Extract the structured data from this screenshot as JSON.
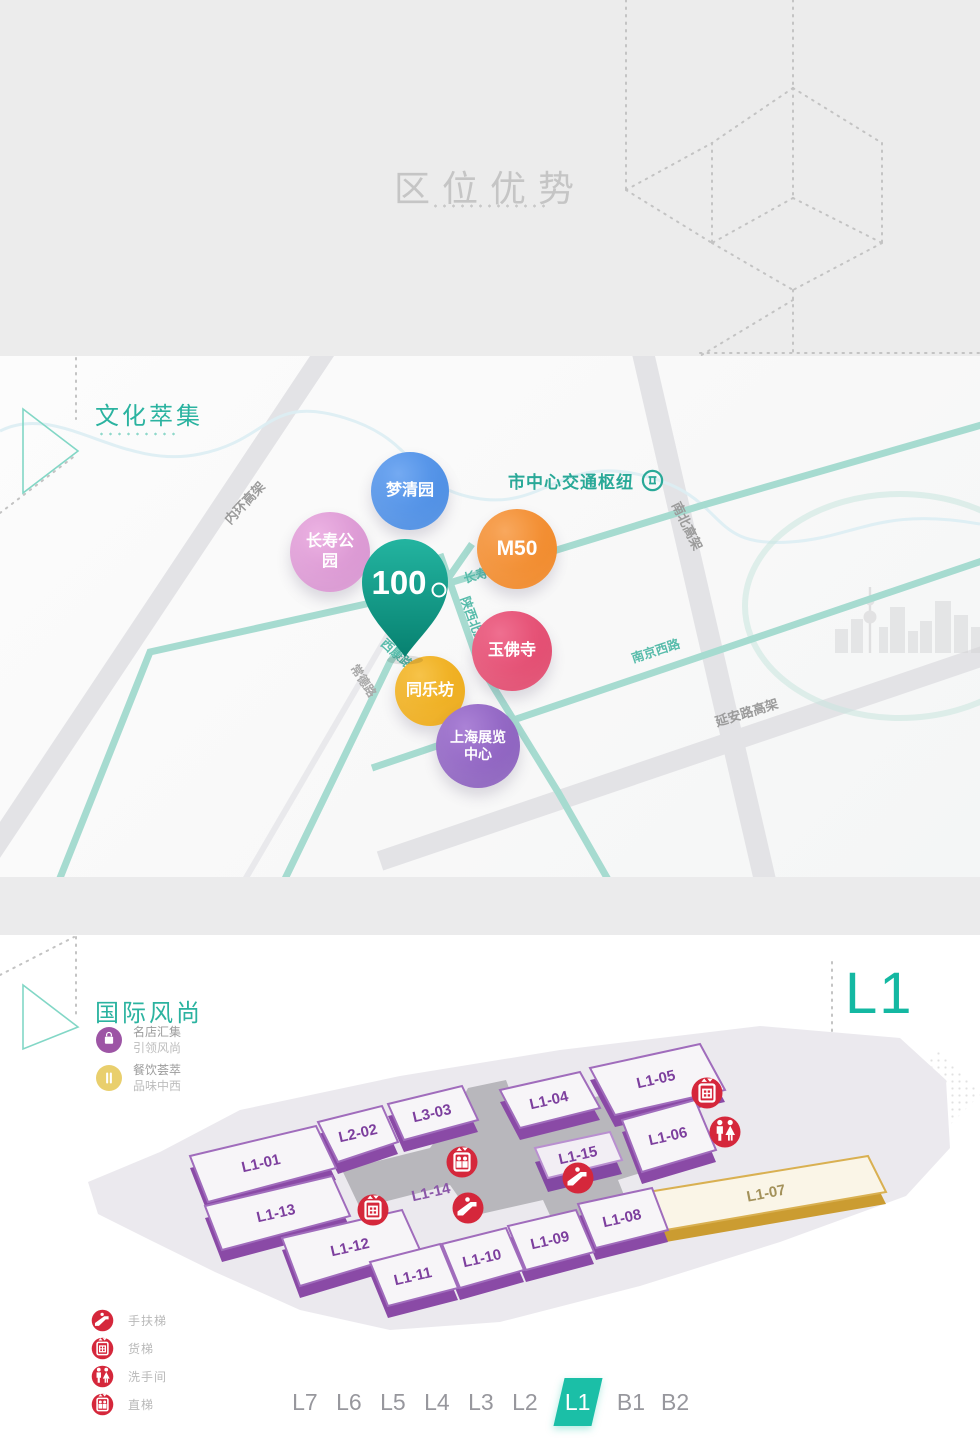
{
  "colors": {
    "accent_teal": "#14b8a2",
    "section_title_teal": "#2bb3a0",
    "header_title_gray": "#c5c5c5",
    "unit_purple": "#7d3f9e",
    "unit_gold": "#cfa43b",
    "facility_red": "#d5273b",
    "highway_gray": "#e3e3e6",
    "teal_road": "#a6dbd0"
  },
  "header": {
    "title": "区位优势"
  },
  "map_section": {
    "title": "文化萃集",
    "hub_label": "市中心交通枢纽",
    "pin_label": "100",
    "pois": [
      {
        "label": "梦清园",
        "color": "#4f94e8"
      },
      {
        "label": "长寿公园",
        "color": "#d790cf"
      },
      {
        "label": "M50",
        "color": "#f0821d"
      },
      {
        "label": "玉佛寺",
        "color": "#e04167"
      },
      {
        "label": "同乐坊",
        "color": "#eda70d"
      },
      {
        "label": "上海展览中心",
        "color": "#8659bb"
      }
    ],
    "roads": [
      {
        "label": "内环高架"
      },
      {
        "label": "南北高架"
      },
      {
        "label": "延安路高架"
      },
      {
        "label": "常德路"
      },
      {
        "label": "长寿路"
      },
      {
        "label": "陕西北路"
      },
      {
        "label": "西康路"
      },
      {
        "label": "南京西路"
      }
    ]
  },
  "floor_section": {
    "title": "国际风尚",
    "floor_label": "L1",
    "features": [
      {
        "icon": "shopping-bag-icon",
        "line1": "名店汇集",
        "line2": "引领风尚",
        "color": "#9d55a5"
      },
      {
        "icon": "dining-icon",
        "line1": "餐饮荟萃",
        "line2": "品味中西",
        "color": "#e9cf6d"
      }
    ],
    "units": [
      {
        "id": "L1-01"
      },
      {
        "id": "L2-02"
      },
      {
        "id": "L3-03"
      },
      {
        "id": "L1-04"
      },
      {
        "id": "L1-05"
      },
      {
        "id": "L1-06"
      },
      {
        "id": "L1-07"
      },
      {
        "id": "L1-08"
      },
      {
        "id": "L1-09"
      },
      {
        "id": "L1-10"
      },
      {
        "id": "L1-11"
      },
      {
        "id": "L1-12"
      },
      {
        "id": "L1-13"
      },
      {
        "id": "L1-14"
      },
      {
        "id": "L1-15"
      }
    ],
    "plan_icons": [
      {
        "name": "elevator-icon"
      },
      {
        "name": "freight-elevator-icon"
      },
      {
        "name": "escalator-icon"
      },
      {
        "name": "escalator-icon"
      },
      {
        "name": "freight-elevator-icon"
      },
      {
        "name": "restroom-icon"
      }
    ],
    "legend": [
      {
        "icon": "escalator-icon",
        "label": "手扶梯"
      },
      {
        "icon": "freight-elevator-icon",
        "label": "货梯"
      },
      {
        "icon": "restroom-icon",
        "label": "洗手间"
      },
      {
        "icon": "elevator-icon",
        "label": "直梯"
      }
    ],
    "floor_nav": {
      "active": "L1",
      "items": [
        {
          "label": "L7"
        },
        {
          "label": "L6"
        },
        {
          "label": "L5"
        },
        {
          "label": "L4"
        },
        {
          "label": "L3"
        },
        {
          "label": "L2"
        },
        {
          "label": "L1"
        },
        {
          "label": "B1"
        },
        {
          "label": "B2"
        }
      ]
    }
  }
}
